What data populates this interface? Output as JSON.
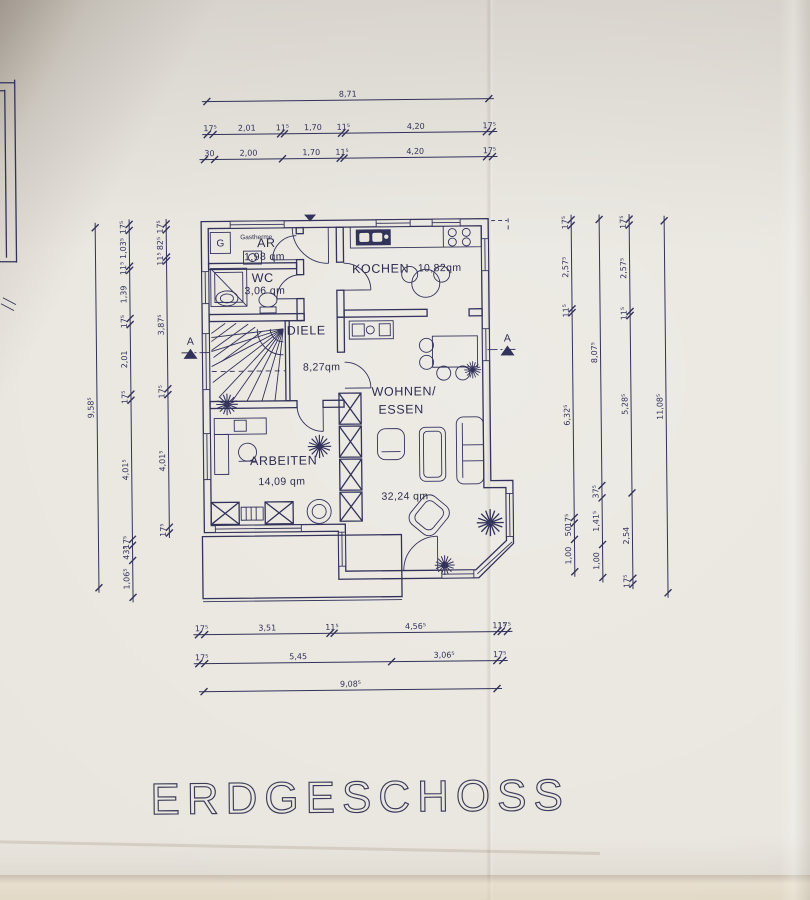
{
  "page": {
    "title_label": "ERDGESCHOSS"
  },
  "plan": {
    "rooms": [
      {
        "id": "ar",
        "label": "AR",
        "area": "1,98 qm"
      },
      {
        "id": "wc",
        "label": "WC",
        "area": "3,06 qm"
      },
      {
        "id": "kochen",
        "label": "KOCHEN",
        "area": "10,82qm"
      },
      {
        "id": "diele",
        "label": "DIELE",
        "area": "8,27qm"
      },
      {
        "id": "arbeiten",
        "label": "ARBEITEN",
        "area": "14,09 qm"
      },
      {
        "id": "wohnen_essen",
        "label": "WOHNEN/",
        "label_line2": "ESSEN",
        "area": "32,24 qm"
      }
    ],
    "annotations": {
      "gastherme": "Gastherme",
      "boiler_letter": "G",
      "section_left": "A",
      "section_right": "A"
    }
  },
  "colors": {
    "paper": "#e9e6df",
    "ink": "#32325a",
    "title": "#3c3c58"
  },
  "dimensions": {
    "ink": "#32325a",
    "chains": [
      {
        "id": "top-total",
        "orient": "h",
        "x": 210,
        "y": 100,
        "len": 282,
        "segments": [
          {
            "label": "8,71",
            "v": 8.71
          }
        ]
      },
      {
        "id": "top-upper",
        "orient": "h",
        "x": 210,
        "y": 133,
        "len": 285,
        "segments": [
          {
            "label": "17⁵",
            "v": 0.175
          },
          {
            "label": "2,01",
            "v": 2.01
          },
          {
            "label": "11⁵",
            "v": 0.115
          },
          {
            "label": "1,70",
            "v": 1.7
          },
          {
            "label": "11⁵",
            "v": 0.115
          },
          {
            "label": "4,20",
            "v": 4.2
          },
          {
            "label": "17⁵",
            "v": 0.175
          }
        ]
      },
      {
        "id": "top-lower",
        "orient": "h",
        "x": 207,
        "y": 158,
        "len": 288,
        "segments": [
          {
            "label": "30",
            "v": 0.3
          },
          {
            "label": "2,00",
            "v": 2.0
          },
          {
            "label": "1,70",
            "v": 1.7
          },
          {
            "label": "11⁵",
            "v": 0.115
          },
          {
            "label": "4,20",
            "v": 4.2
          },
          {
            "label": "17⁵",
            "v": 0.175
          }
        ]
      },
      {
        "id": "bottom-1",
        "orient": "h",
        "x": 196,
        "y": 633,
        "len": 309,
        "segments": [
          {
            "label": "17⁵",
            "v": 0.175
          },
          {
            "label": "3,51",
            "v": 3.51
          },
          {
            "label": "11⁵",
            "v": 0.115
          },
          {
            "label": "4,56⁵",
            "v": 4.565
          },
          {
            "label": "11⁵",
            "v": 0.115
          },
          {
            "label": "17⁵",
            "v": 0.175
          }
        ]
      },
      {
        "id": "bottom-2",
        "orient": "h",
        "x": 196,
        "y": 662,
        "len": 304,
        "segments": [
          {
            "label": "17⁵",
            "v": 0.175
          },
          {
            "label": "5,45",
            "v": 5.45
          },
          {
            "label": "3,06⁵",
            "v": 3.065
          },
          {
            "label": "17⁵",
            "v": 0.175
          }
        ]
      },
      {
        "id": "bottom-total",
        "orient": "h",
        "x": 201,
        "y": 690,
        "len": 293,
        "segments": [
          {
            "label": "9,08⁵",
            "v": 9.085
          }
        ]
      },
      {
        "id": "left-total",
        "orient": "v",
        "x": 97,
        "y": 225,
        "len": 360,
        "segments": [
          {
            "label": "9,58⁵",
            "v": 9.585
          }
        ]
      },
      {
        "id": "left-outer",
        "orient": "v",
        "x": 131,
        "y": 222,
        "len": 373,
        "segments": [
          {
            "label": "17⁵",
            "v": 0.175
          },
          {
            "label": "1,03⁵",
            "v": 1.035
          },
          {
            "label": "11⁵",
            "v": 0.115
          },
          {
            "label": "1,39",
            "v": 1.39
          },
          {
            "label": "17⁵",
            "v": 0.175
          },
          {
            "label": "2,01",
            "v": 2.01
          },
          {
            "label": "17⁵",
            "v": 0.175
          },
          {
            "label": "4,01⁵",
            "v": 4.015
          },
          {
            "label": "17⁵",
            "v": 0.175
          },
          {
            "label": "43⁵",
            "v": 0.435
          },
          {
            "label": "1,06⁵",
            "v": 1.065
          }
        ]
      },
      {
        "id": "left-inner",
        "orient": "v",
        "x": 168,
        "y": 222,
        "len": 309,
        "segments": [
          {
            "label": "17⁵",
            "v": 0.175
          },
          {
            "label": "82⁵",
            "v": 0.825
          },
          {
            "label": "11⁵",
            "v": 0.115
          },
          {
            "label": "3,87⁵",
            "v": 3.875
          },
          {
            "label": "17⁵",
            "v": 0.175
          },
          {
            "label": "4,01⁵",
            "v": 4.015
          },
          {
            "label": "17⁵",
            "v": 0.175
          }
        ]
      },
      {
        "id": "right-inner",
        "orient": "v",
        "x": 573,
        "y": 222,
        "len": 352,
        "segments": [
          {
            "label": "17⁵",
            "v": 0.175
          },
          {
            "label": "2,57⁵",
            "v": 2.575
          },
          {
            "label": "11⁵",
            "v": 0.115
          },
          {
            "label": "6,32⁵",
            "v": 6.325
          },
          {
            "label": "17⁵",
            "v": 0.175
          },
          {
            "label": "50",
            "v": 0.5
          },
          {
            "label": "1,00",
            "v": 1.0
          }
        ]
      },
      {
        "id": "right-mid1",
        "orient": "v",
        "x": 601,
        "y": 222,
        "len": 358,
        "segments": [
          {
            "label": "8,07⁵",
            "v": 8.075
          },
          {
            "label": "37⁵",
            "v": 0.375
          },
          {
            "label": "1,41⁵",
            "v": 1.415
          },
          {
            "label": "1,00",
            "v": 1.0
          }
        ]
      },
      {
        "id": "right-mid2",
        "orient": "v",
        "x": 631,
        "y": 222,
        "len": 365,
        "segments": [
          {
            "label": "17⁵",
            "v": 0.175
          },
          {
            "label": "2,57⁵",
            "v": 2.575
          },
          {
            "label": "11⁵",
            "v": 0.115
          },
          {
            "label": "5,28⁵",
            "v": 5.285
          },
          {
            "label": "2,54",
            "v": 2.54
          },
          {
            "label": "17⁵",
            "v": 0.175
          }
        ]
      },
      {
        "id": "right-total",
        "orient": "v",
        "x": 666,
        "y": 224,
        "len": 372,
        "segments": [
          {
            "label": "11,08⁵",
            "v": 11.085
          }
        ]
      }
    ]
  }
}
